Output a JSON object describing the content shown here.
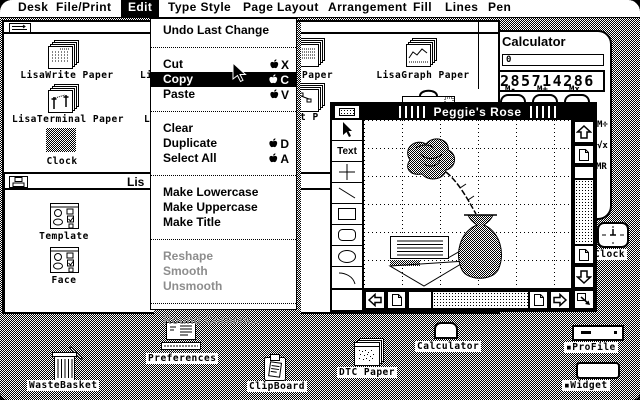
{
  "colors": {
    "ui_fg": "#000000",
    "ui_bg": "#ffffff",
    "desktop_dither": "#000000 on #ffffff 50%"
  },
  "menu_bar": {
    "items": [
      {
        "label": "Desk"
      },
      {
        "label": "File/Print"
      },
      {
        "label": "Edit"
      },
      {
        "label": "Type Style"
      },
      {
        "label": "Page Layout"
      },
      {
        "label": "Arrangement"
      },
      {
        "label": "Fill"
      },
      {
        "label": "Lines"
      },
      {
        "label": "Pen"
      }
    ],
    "active_item": "Edit"
  },
  "edit_menu": {
    "items": [
      {
        "label": "Undo Last Change",
        "shortcut": "",
        "state": "enabled"
      },
      {
        "label": "Cut",
        "shortcut": "X",
        "state": "enabled"
      },
      {
        "label": "Copy",
        "shortcut": "C",
        "state": "selected"
      },
      {
        "label": "Paste",
        "shortcut": "V",
        "state": "enabled"
      },
      {
        "label": "Clear",
        "shortcut": "",
        "state": "enabled"
      },
      {
        "label": "Duplicate",
        "shortcut": "D",
        "state": "enabled"
      },
      {
        "label": "Select All",
        "shortcut": "A",
        "state": "enabled"
      },
      {
        "label": "Make Lowercase",
        "shortcut": "",
        "state": "enabled"
      },
      {
        "label": "Make Uppercase",
        "shortcut": "",
        "state": "enabled"
      },
      {
        "label": "Make Title",
        "shortcut": "",
        "state": "enabled"
      },
      {
        "label": "Reshape",
        "shortcut": "",
        "state": "disabled"
      },
      {
        "label": "Smooth",
        "shortcut": "",
        "state": "disabled"
      },
      {
        "label": "Unsmooth",
        "shortcut": "",
        "state": "disabled"
      },
      {
        "label": "Round Corners...",
        "shortcut": "",
        "state": "disabled"
      }
    ],
    "modifier_icon": "apple-key"
  },
  "window_a": {
    "labels": {
      "lisawrite_paper": "LisaWrite Paper",
      "fragment_li": "Li",
      "lisaterminal_paper": "LisaTerminal Paper",
      "fragment_l": "L",
      "clock": "Clock",
      "fragment_paper": "Paper",
      "lisagraph_paper": "LisaGraph Paper",
      "fragment_t_p": "t P",
      "fragment_pla": "Pla"
    }
  },
  "window_b": {
    "title_fragment": "Lis",
    "template_label": "Template",
    "face_label": "Face"
  },
  "draw_window": {
    "title": "Peggie's Rose",
    "text_tool_label": "Text",
    "tools": [
      "selection-arrow",
      "text",
      "crosshair",
      "line",
      "rectangle",
      "rounded-rectangle",
      "ellipse",
      "arc"
    ]
  },
  "calculator": {
    "title": "Calculator",
    "display_memory": "0",
    "display_main": "285714286",
    "btn_m_minus": "M-",
    "btn_m_plus": "M+",
    "btn_m_times": "Mx",
    "btn_m_div": "M÷",
    "btn_sqrt": "√x",
    "btn_mr": "MR"
  },
  "desktop_icons": {
    "wastebasket": "WasteBasket",
    "preferences": "Preferences",
    "clipboard": "ClipBoard",
    "dtc_paper": "DTC Paper",
    "calculator": "Calculator",
    "clock": "Clock",
    "profile": "▪ProFile",
    "widget": "▪Widget"
  },
  "icons": {
    "apple_key": "apple-silhouette",
    "mouse_cursor": "arrow-pointer",
    "scroll_arrows": "hollow up/down/left/right",
    "page_jump": "dog-eared page",
    "resize_corner": "box with diagonal arrow"
  }
}
